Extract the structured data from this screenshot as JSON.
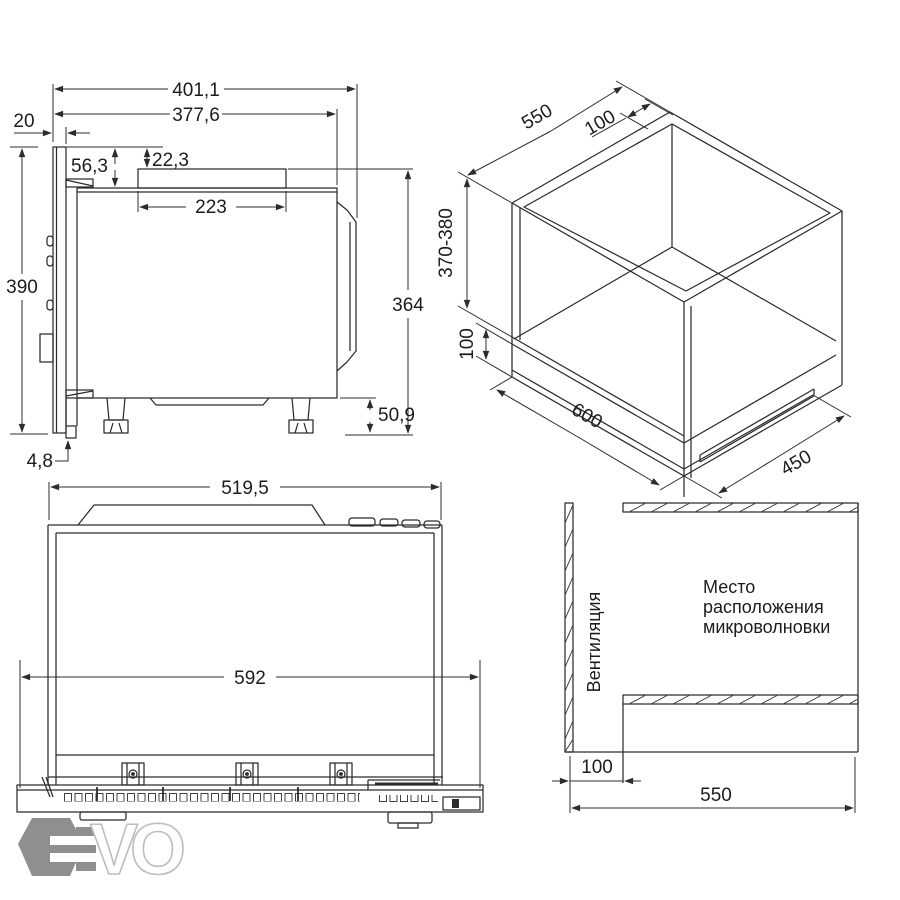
{
  "drawing": {
    "side_view": {
      "dims": {
        "total_depth": "401,1",
        "body_depth": "377,6",
        "front_protrusion": "20",
        "top_clearance": "56,3",
        "duct_offset": "22,3",
        "duct_width": "223",
        "total_height": "390",
        "body_height": "364",
        "feet_height": "50,9",
        "base_thickness": "4,8"
      }
    },
    "niche_view": {
      "dims": {
        "depth": "550",
        "rear_gap": "100",
        "height": "370-380",
        "bottom_gap": "100",
        "width": "600",
        "shelf_depth": "450"
      }
    },
    "top_view": {
      "dims": {
        "body_width": "519,5",
        "frame_width": "592"
      }
    },
    "section_view": {
      "vent_label": "Вентиляция",
      "location_lines": [
        "Место",
        "расположения",
        "микроволновки"
      ],
      "dims": {
        "vent_width": "100",
        "depth": "550"
      }
    },
    "watermark": {
      "letters": "VO"
    },
    "colors": {
      "line": "#2c2c2c",
      "watermark_hex": "#8f8f8f",
      "watermark_outline": "#bdbdbd",
      "background": "#ffffff"
    }
  }
}
